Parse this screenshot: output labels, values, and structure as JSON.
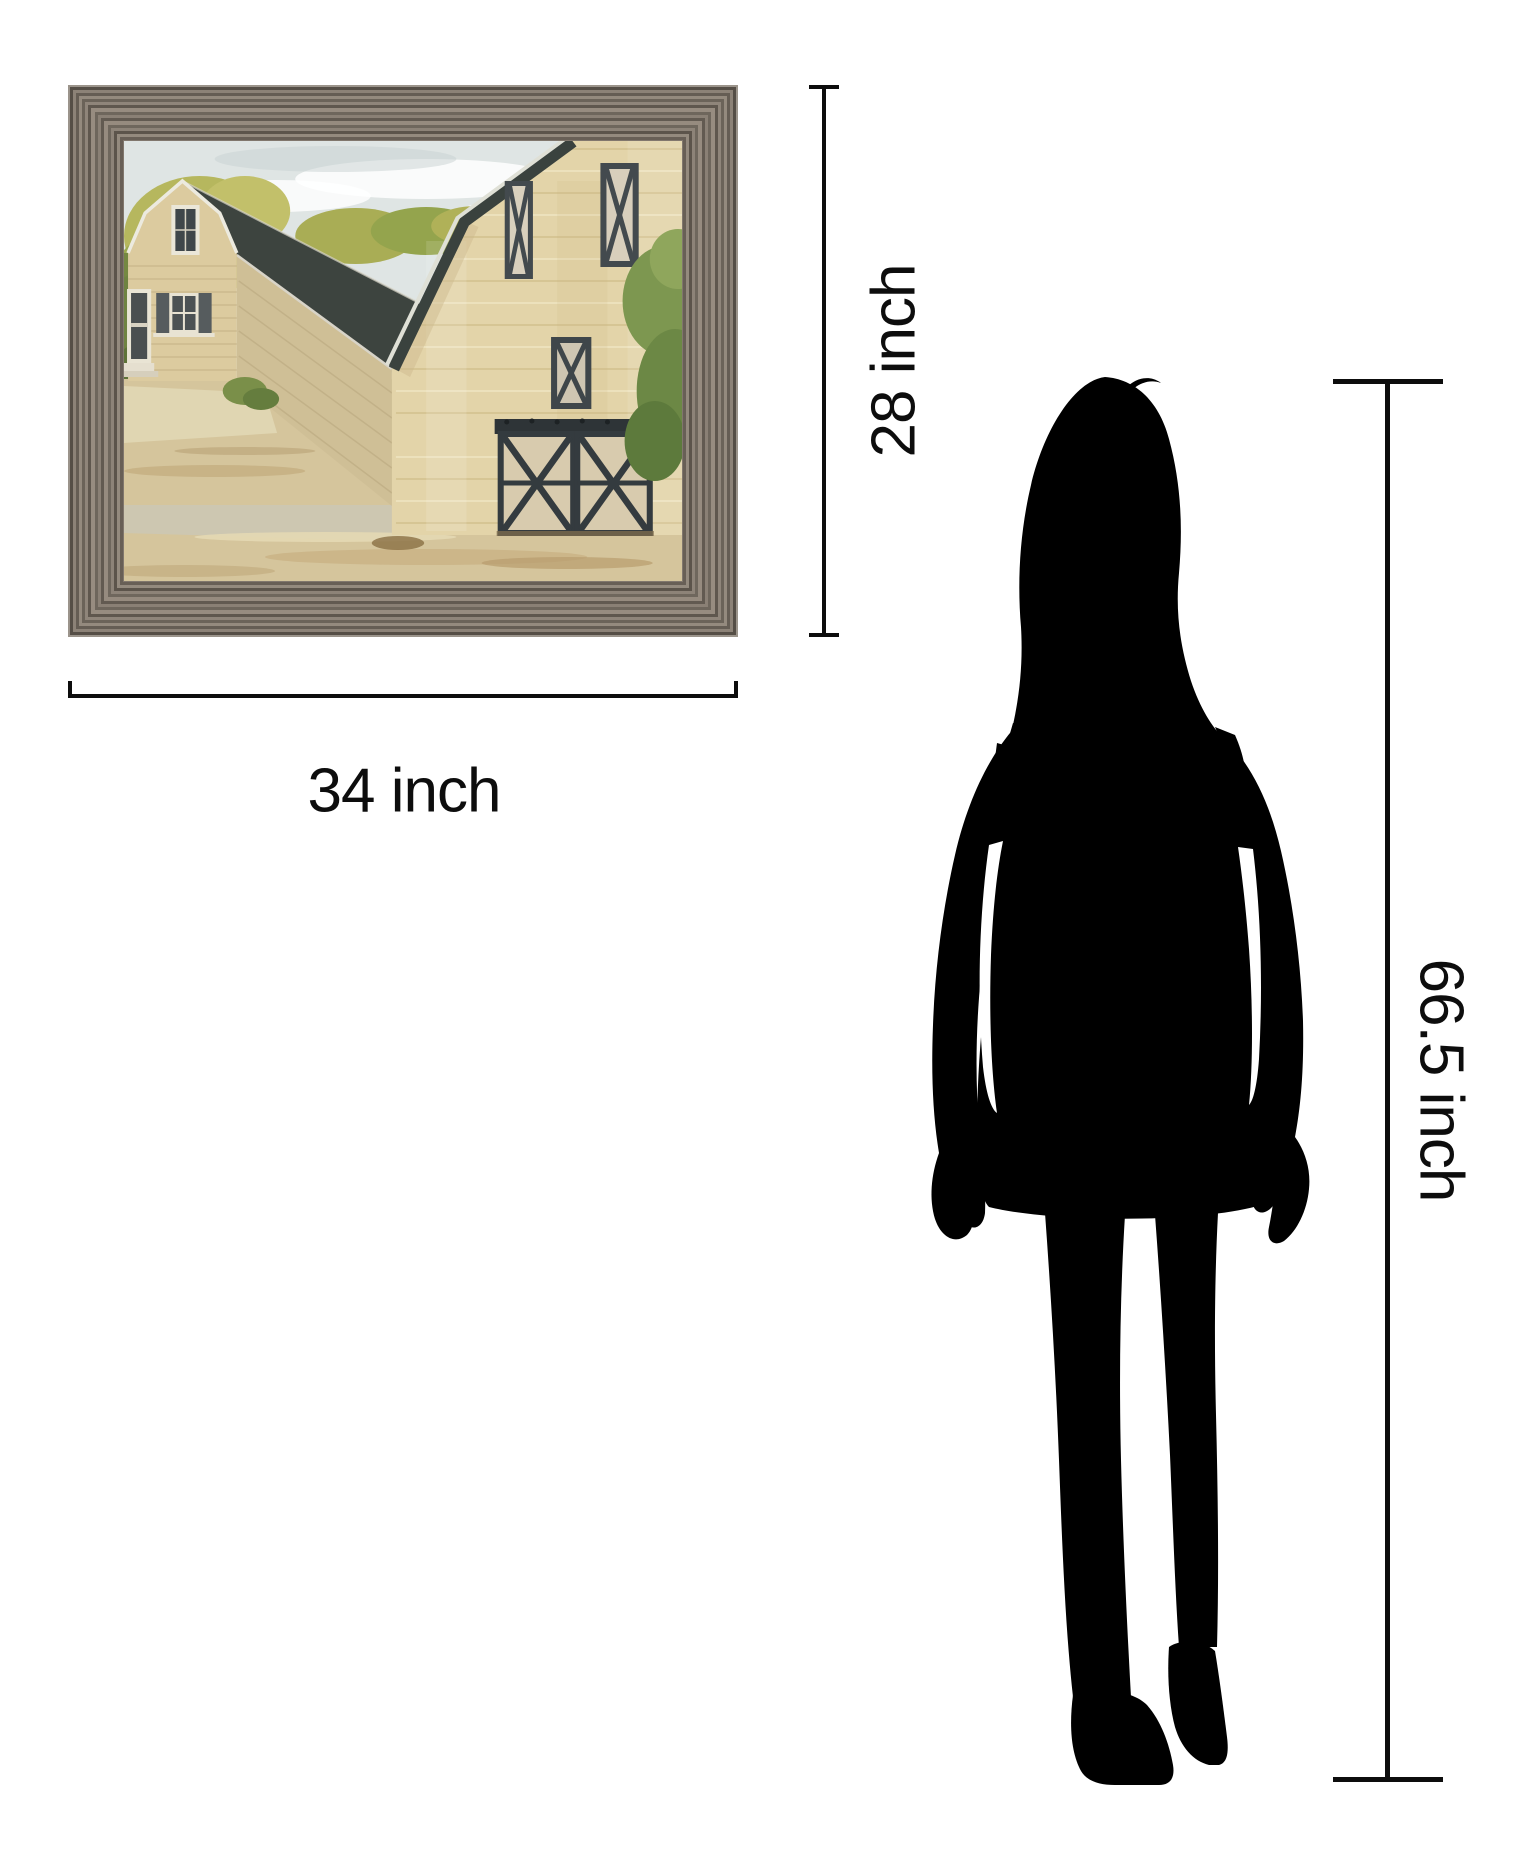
{
  "page": {
    "background_color": "#ffffff"
  },
  "artwork": {
    "description": "Framed print of a tan farmhouse and barn with dark roofs, green trees and sandy ground",
    "frame": {
      "base_color": "#847a70",
      "ridge_dark": "#5c544b",
      "ridge_light": "#968b7f"
    },
    "palette": {
      "sky": "#dfe5e4",
      "cloud": "#ffffff",
      "foliage_light": "#b6b75e",
      "foliage_mid": "#94a44d",
      "foliage_dark": "#5e7338",
      "house_siding": "#dccb9f",
      "house_siding_shadow": "#cfbf96",
      "barn_wall": "#e3d4a9",
      "roof_dark": "#3d443f",
      "trim_light": "#eceadf",
      "trim_dark": "#434a4e",
      "ground_sand": "#d5c59c",
      "ground_path": "#ccc6b4"
    }
  },
  "dimensions": {
    "height_label": "28 inch",
    "width_label": "34 inch",
    "person_height_label": "66.5 inch",
    "line_color": "#0d0d0d"
  },
  "person": {
    "description": "Standing woman silhouette shown for scale",
    "color": "#000000"
  }
}
